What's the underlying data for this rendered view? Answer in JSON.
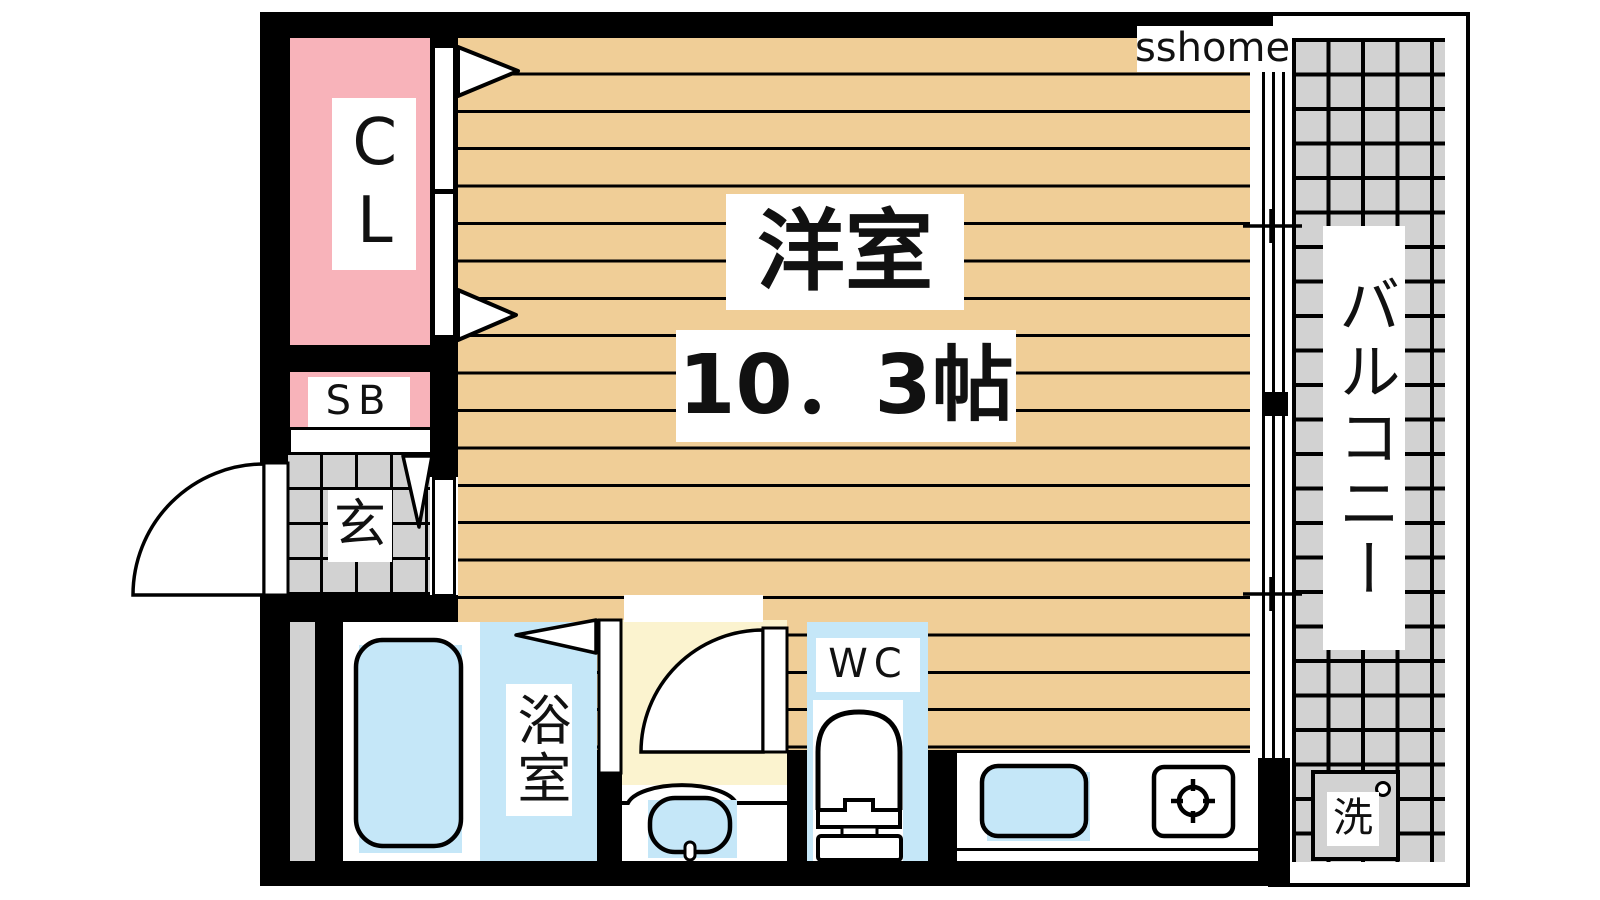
{
  "watermark": {
    "text": "sshome"
  },
  "plan": {
    "rooms": {
      "main_room": {
        "label": "洋室",
        "size": "10．3帖"
      },
      "closet": {
        "label": "CL"
      },
      "shoe_box": {
        "label": "SB"
      },
      "entrance": {
        "label": "玄"
      },
      "bathroom": {
        "label": "浴室"
      },
      "toilet_room": {
        "label": "WC"
      },
      "balcony": {
        "label": "バルコニー"
      },
      "laundry_pan": {
        "label": "洗"
      }
    },
    "fixtures": [
      "bathtub",
      "wash-basin",
      "toilet",
      "kitchen-sink",
      "gas-stove",
      "washer-pan",
      "entrance-door",
      "closet-sliding-doors",
      "bathroom-folding-door",
      "washroom-door",
      "balcony-window"
    ],
    "colors": {
      "wall": "#000000",
      "flooring": "#F0CE97",
      "closet_pink": "#F8B3BA",
      "water_blue": "#C5E7F8",
      "washroom_yellow": "#FBF3CF",
      "tile_gray": "#D2D2D2",
      "bg": "#FFFFFF"
    }
  }
}
